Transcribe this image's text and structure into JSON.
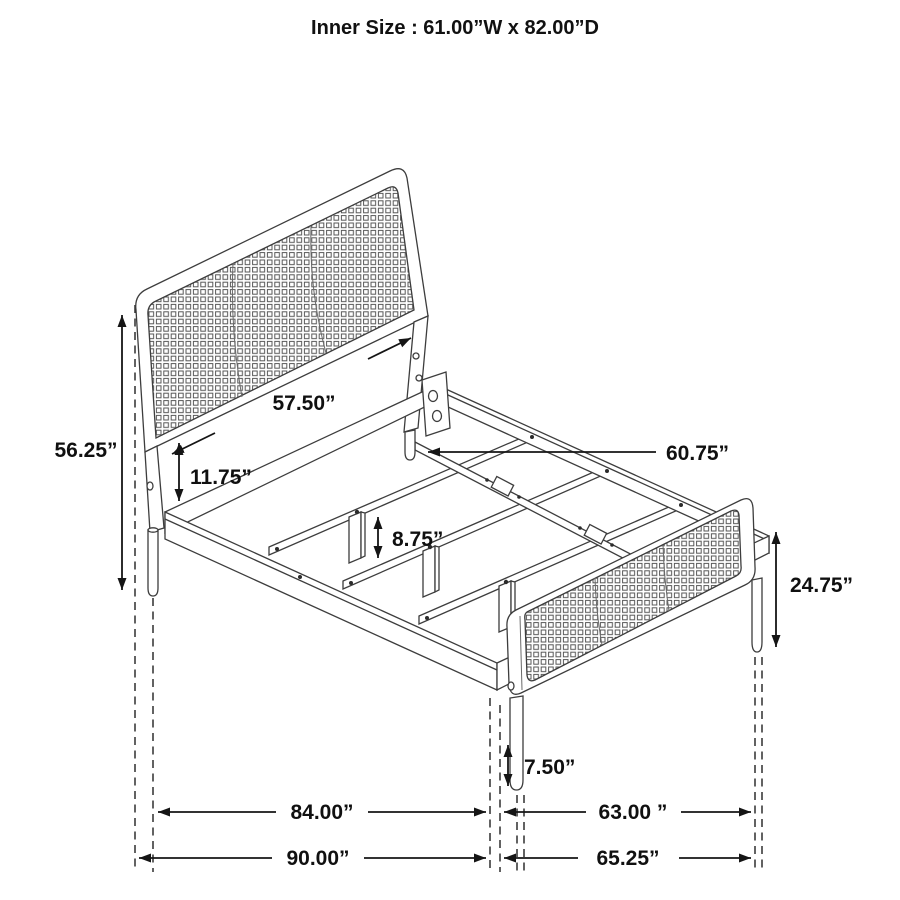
{
  "title": "Inner Size : 61.00”W x 82.00”D",
  "diagram": {
    "type": "furniture-dimension-drawing",
    "subject": "bed frame with woven cane headboard and footboard",
    "units": "inches"
  },
  "dimensions": {
    "inner_width": "61.00”W",
    "inner_depth": "82.00”D",
    "headboard_height": "56.25”",
    "headboard_width": "57.50”",
    "headboard_rail_gap": "11.75”",
    "slat_leg_height": "8.75”",
    "center_rail_length": "60.75”",
    "footboard_height": "24.75”",
    "footboard_leg_height": "7.50”",
    "frame_length": "84.00”",
    "footboard_width": "63.00 ”",
    "overall_length": "90.00”",
    "footboard_overall_width": "65.25”"
  }
}
